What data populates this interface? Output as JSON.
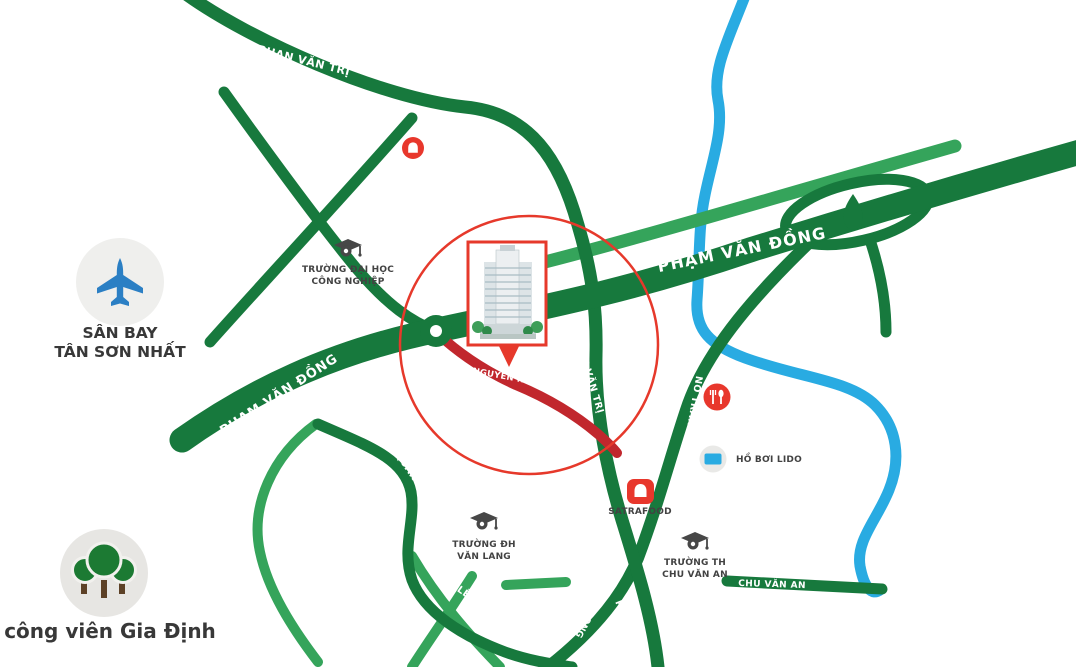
{
  "map": {
    "colors": {
      "road_dark_green": "#17793d",
      "road_light_green": "#35a45b",
      "road_highlight_red": "#c1272d",
      "river_blue": "#29abe2",
      "accent_red": "#e6392b",
      "icon_circle_gray": "#ebebe9",
      "plane_blue": "#2b7fc4",
      "tree_green": "#1c7a33",
      "trunk_brown": "#5d4127",
      "text_dark": "#3a3a3a"
    },
    "road_labels": {
      "phan_van_tri_top": "PHAN VĂN TRỊ",
      "nguyen_van_nghi": "NGUYỄN VĂN NGHI",
      "pham_van_dong_upper": "PHẠM VĂN ĐỒNG",
      "pham_van_dong_lower": "PHẠM VĂN ĐỒNG",
      "nguyen_hong": "NGUYỄN HỒNG",
      "phan_van_tri_mid": "PHAN VĂN TRỊ",
      "phan_van_tri_bottom": "PHAN VĂN TRỊ",
      "no_trang_long_upper": "NƠ TRANG LONG",
      "no_trang_long_lower": "NƠ TRANG LONG",
      "le_quang_dinh_upper": "LÊ QUANG ĐỊNH",
      "le_quang_dinh_lower": "LÊ QUANG ĐỊNH",
      "chu_van_an": "CHU VĂN AN",
      "partial_nguyen": "UYỄN"
    },
    "pois": {
      "airport": {
        "line1": "SÂN BAY",
        "line2": "TÂN SƠN NHẤT"
      },
      "park": {
        "label": "công viên Gia Định"
      },
      "univ_cong_nghiep": {
        "line1": "TRƯỜNG ĐẠI HỌC",
        "line2": "CÔNG NGHIỆP"
      },
      "univ_van_lang": {
        "line1": "TRƯỜNG ĐH",
        "line2": "VĂN LANG"
      },
      "school_chu_van_an": {
        "line1": "TRƯỜNG TH",
        "line2": "CHU VĂN AN"
      },
      "satrafood": {
        "label": "SATRAFOOD"
      },
      "ho_boi_lido": {
        "label": "HỒ BƠI LIDO"
      }
    }
  }
}
